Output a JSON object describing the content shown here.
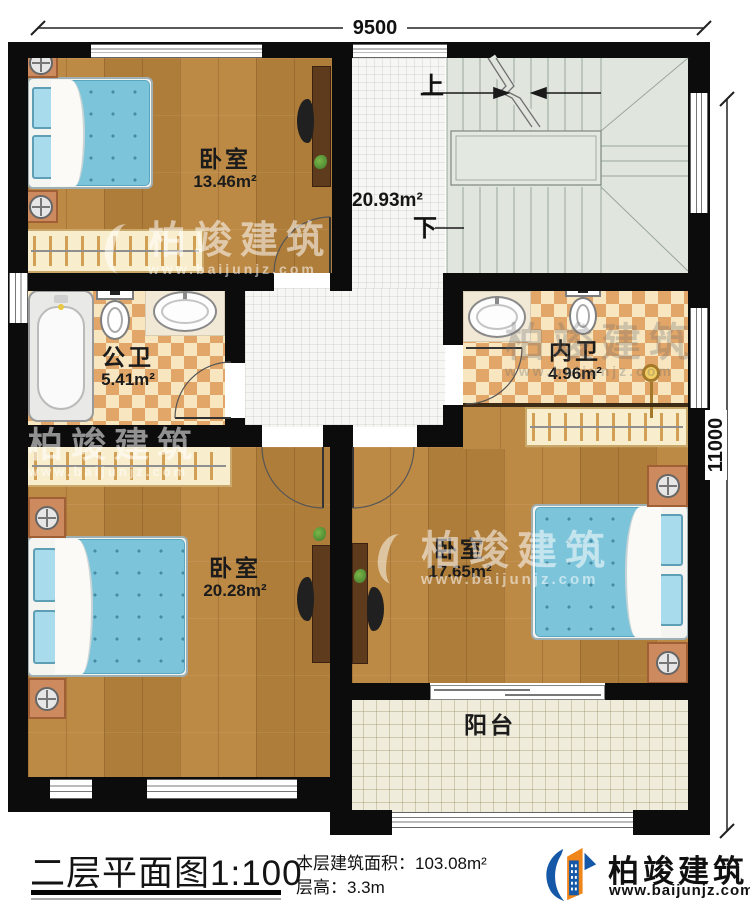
{
  "plan": {
    "dimension_top": "9500",
    "dimension_right": "11000",
    "stair_up": "上",
    "stair_down": "下",
    "hall_area": "20.93m²"
  },
  "rooms": {
    "bedroom_tl": {
      "name": "卧室",
      "area": "13.46m²"
    },
    "bath_public": {
      "name": "公卫",
      "area": "5.41m²"
    },
    "bath_ensuite": {
      "name": "内卫",
      "area": "4.96m²"
    },
    "bedroom_bl": {
      "name": "卧室",
      "area": "20.28m²"
    },
    "bedroom_br": {
      "name": "卧室",
      "area": "17.65m²"
    },
    "balcony": {
      "name": "阳台"
    }
  },
  "watermark": {
    "brand": "柏竣建筑",
    "url": "www.baijunjz.com"
  },
  "title_block": {
    "plan_title": "二层平面图",
    "scale": "1:100",
    "area_label": "本层建筑面积：",
    "area_value": "103.08m²",
    "height_label": "层高：",
    "height_value": "3.3m"
  },
  "brand": {
    "name": "柏竣建筑",
    "url": "www.baijunjz.com"
  },
  "colors": {
    "wall": "#0c0c0c",
    "wood_floor": "#b8833f",
    "hall_tile": "#f6f6f4",
    "bath_checker_dark": "#e2a768",
    "bath_checker_light": "#f7e6c0",
    "stair_floor": "#e0e6de",
    "balcony_tile": "#efecdb",
    "bed_blue": "#7cc4da",
    "logo_blue": "#1558a7",
    "logo_orange": "#f08519"
  }
}
